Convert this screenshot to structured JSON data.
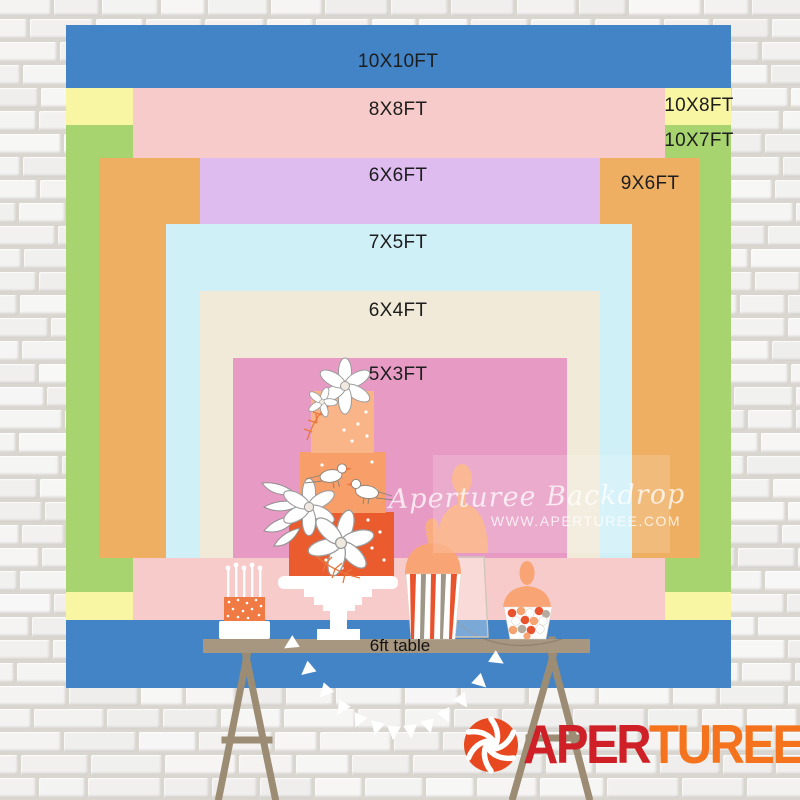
{
  "backdrops": [
    {
      "id": "10x10",
      "label": "10X10FT",
      "width_ft": 10,
      "height_ft": 10,
      "color": "#4384C6"
    },
    {
      "id": "10x8",
      "label": "10X8FT",
      "width_ft": 10,
      "height_ft": 8,
      "color": "#F8F5A3"
    },
    {
      "id": "10x7",
      "label": "10X7FT",
      "width_ft": 10,
      "height_ft": 7,
      "color": "#A8D46F"
    },
    {
      "id": "8x8",
      "label": "8X8FT",
      "width_ft": 8,
      "height_ft": 8,
      "color": "#F7CBC9"
    },
    {
      "id": "9x6",
      "label": "9X6FT",
      "width_ft": 9,
      "height_ft": 6,
      "color": "#EFAF62"
    },
    {
      "id": "6x6",
      "label": "6X6FT",
      "width_ft": 6,
      "height_ft": 6,
      "color": "#DEBCEF"
    },
    {
      "id": "7x5",
      "label": "7X5FT",
      "width_ft": 7,
      "height_ft": 5,
      "color": "#D0F0F8"
    },
    {
      "id": "6x4",
      "label": "6X4FT",
      "width_ft": 6,
      "height_ft": 4,
      "color": "#F1EAD9"
    },
    {
      "id": "5x3",
      "label": "5X3FT",
      "width_ft": 5,
      "height_ft": 3,
      "color": "#E79BC4"
    }
  ],
  "table": {
    "label": "6ft table",
    "top_color": "#A79781",
    "leg_color": "#9C8C74"
  },
  "watermark": {
    "line1": "Aperturee Backdrop",
    "line2": "WWW.APERTUREE.COM"
  },
  "logo": {
    "part1": "APER",
    "part2": "TUREE",
    "part1_color": "#CF2027",
    "part2_color": "#F4731C"
  }
}
